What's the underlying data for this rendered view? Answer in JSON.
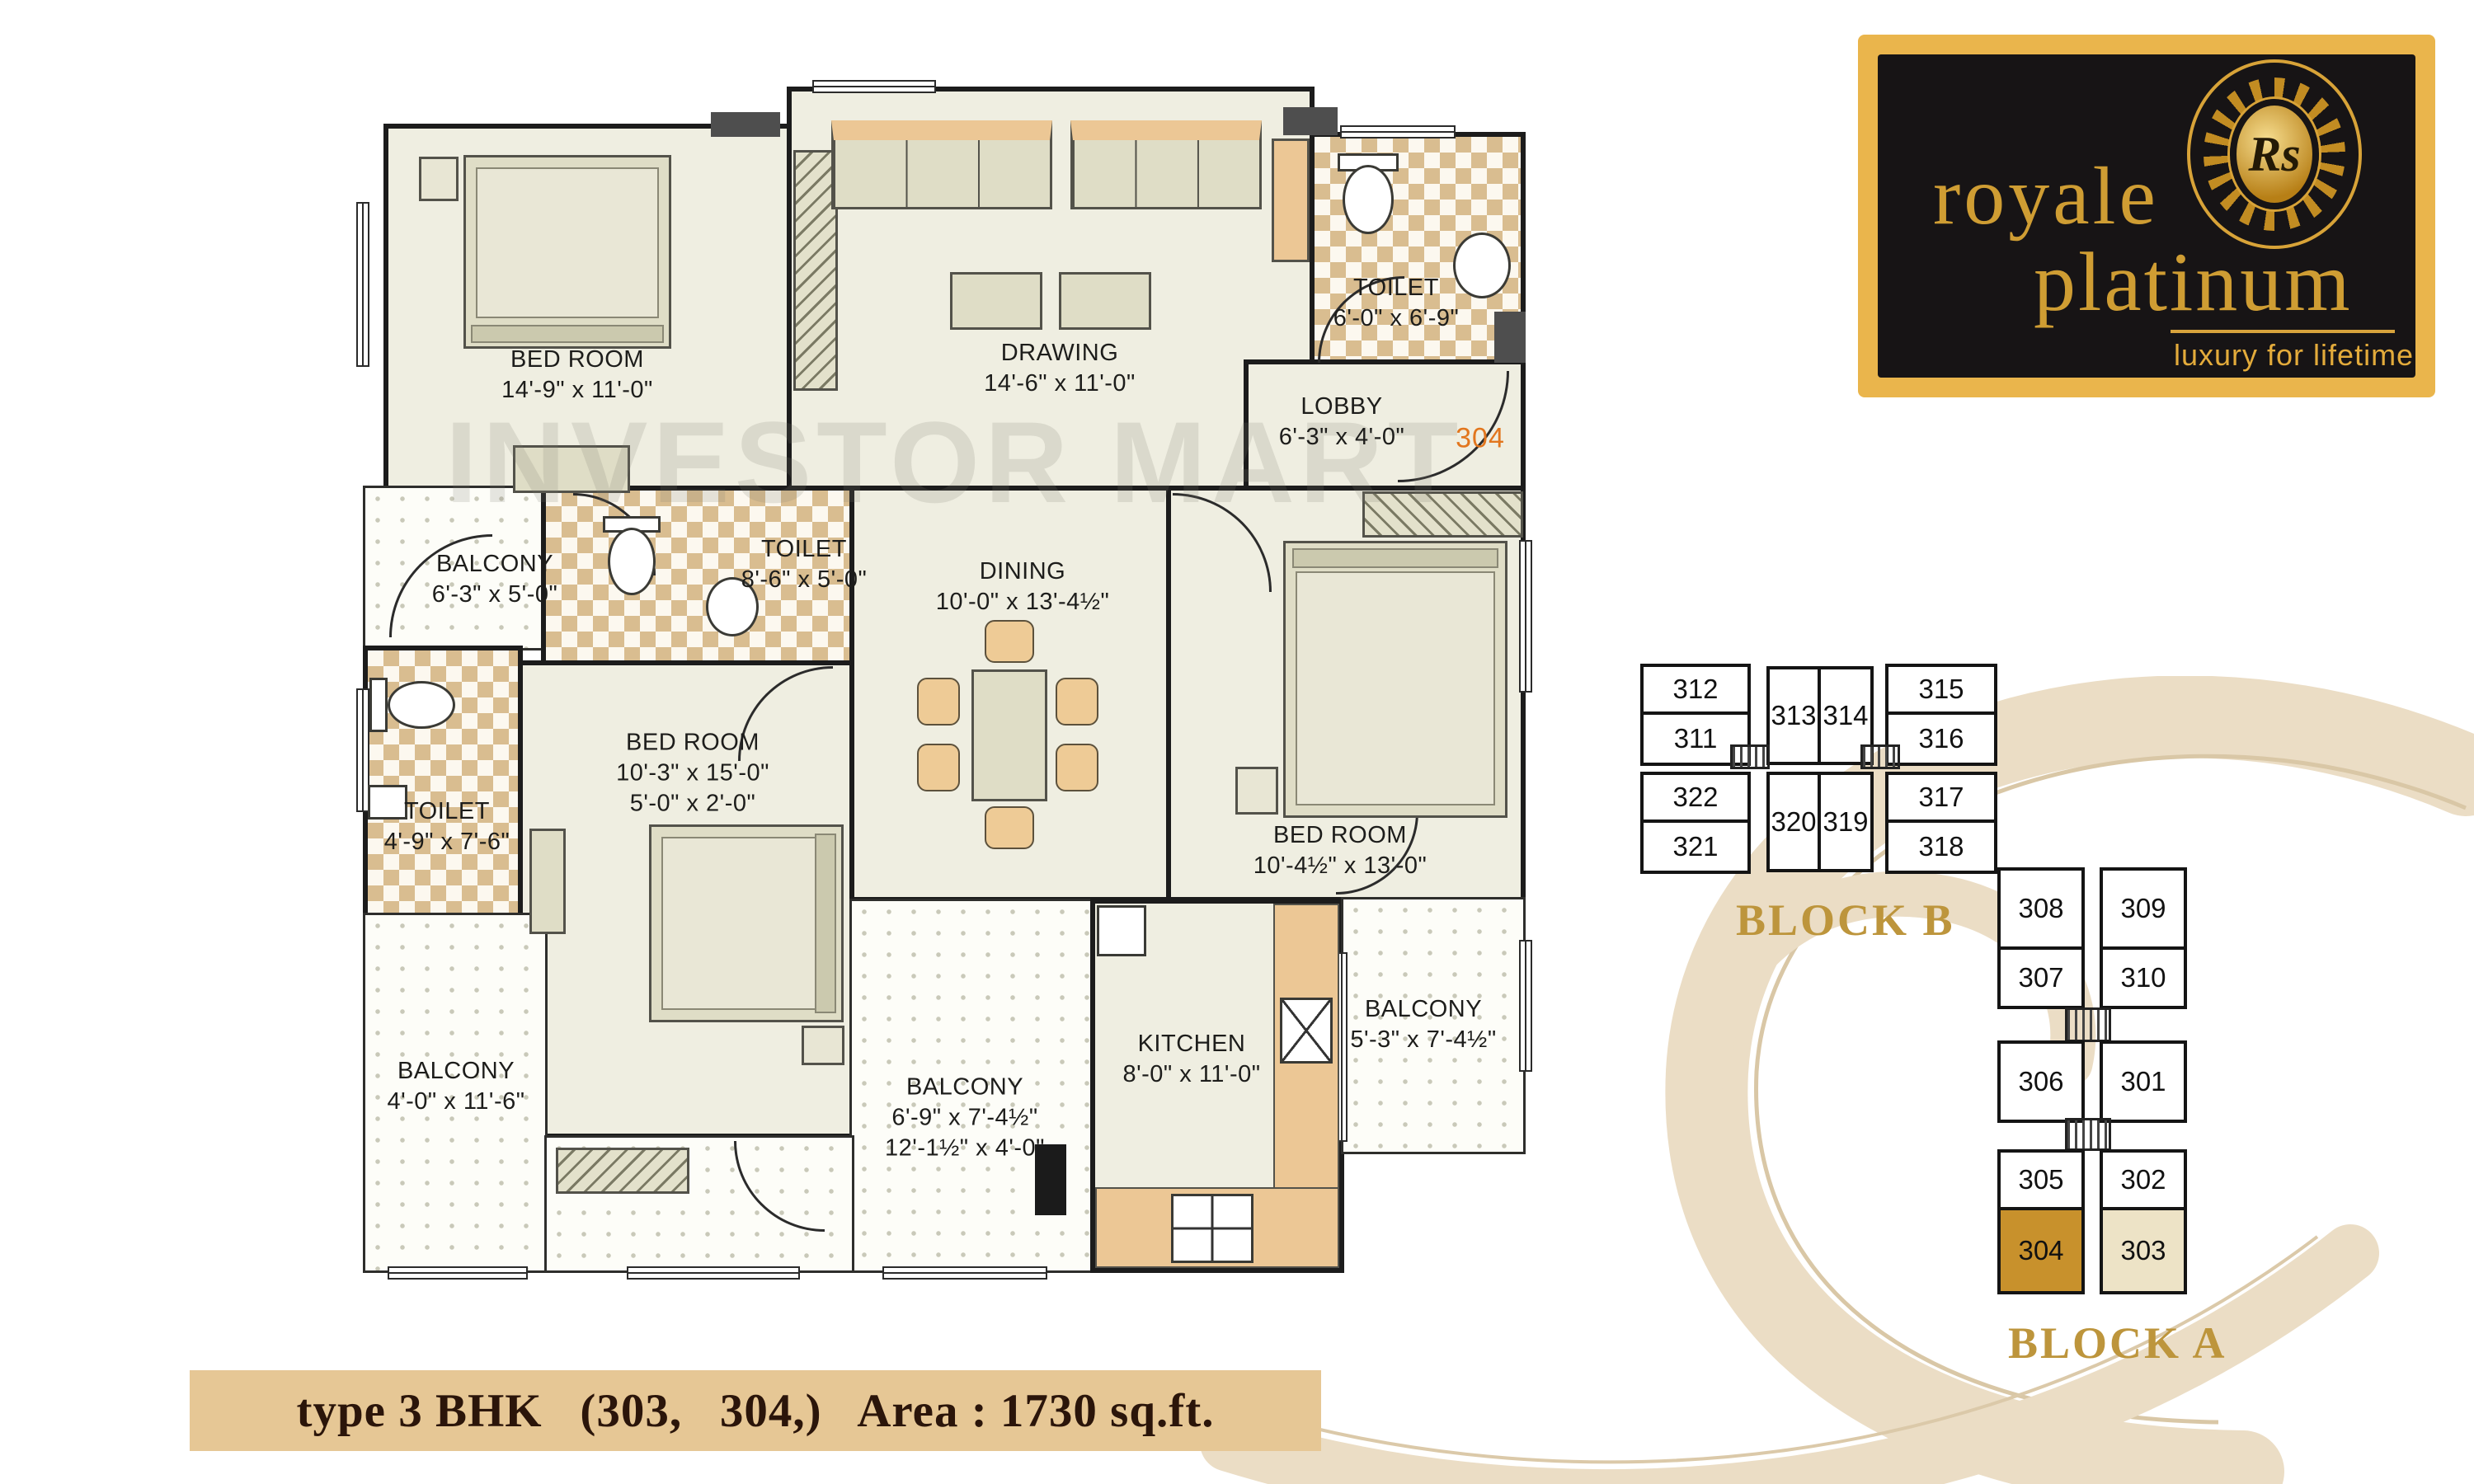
{
  "watermark": "INVESTOR MART",
  "plan": {
    "unit_number": "304",
    "rooms": [
      {
        "name": "BED ROOM",
        "d1": "14'-9\" x 11'-0\""
      },
      {
        "name": "DRAWING",
        "d1": "14'-6\" x 11'-0\""
      },
      {
        "name": "TOILET",
        "d1": "6'-0\" x 6'-9\""
      },
      {
        "name": "LOBBY",
        "d1": "6'-3\" x 4'-0\""
      },
      {
        "name": "BALCONY",
        "d1": "6'-3\" x 5'-0\""
      },
      {
        "name": "TOILET",
        "d1": "8'-6\" x 5'-0\""
      },
      {
        "name": "DINING",
        "d1": "10'-0\" x 13'-4½\""
      },
      {
        "name": "TOILET",
        "d1": "4'-9\" x 7'-6\""
      },
      {
        "name": "BED ROOM",
        "d1": "10'-3\" x 15'-0\"",
        "d2": "5'-0\" x 2'-0\""
      },
      {
        "name": "BED ROOM",
        "d1": "10'-4½\" x 13'-0\""
      },
      {
        "name": "BALCONY",
        "d1": "4'-0\" x 11'-6\""
      },
      {
        "name": "BALCONY",
        "d1": "6'-9\" x 7'-4½\"",
        "d2": "12'-1½\" x 4'-0\""
      },
      {
        "name": "KITCHEN",
        "d1": "8'-0\" x 11'-0\""
      },
      {
        "name": "BALCONY",
        "d1": "5'-3\" x 7'-4½\""
      }
    ]
  },
  "logo": {
    "name_line1": "royale",
    "name_line2": "platinum",
    "tagline": "luxury for lifetime",
    "monogram": "Rs"
  },
  "block_b": {
    "label": "BLOCK B",
    "units": [
      "312",
      "311",
      "313",
      "314",
      "315",
      "316",
      "322",
      "321",
      "320",
      "319",
      "317",
      "318"
    ]
  },
  "block_a": {
    "label": "BLOCK A",
    "units": [
      "308",
      "309",
      "307",
      "310",
      "306",
      "301",
      "305",
      "302",
      "304",
      "303"
    ],
    "highlighted_dark": "304",
    "highlighted_light": "303"
  },
  "footer": {
    "text": "type 3 BHK   (303,   304,)   Area : 1730 sq.ft."
  },
  "colors": {
    "wall": "#1b1b1b",
    "floor": "#efeee1",
    "toilet_tile_tan": "#d9bd90",
    "gold_frame": "#eab54c",
    "logo_text_gold": "#cf9d33",
    "block_label_gold": "#bd953c",
    "unit_304_fill": "#c8912c",
    "unit_303_fill": "#ede3c6",
    "footer_bg": "#e6c795",
    "unit_number_orange": "#e2761e"
  }
}
